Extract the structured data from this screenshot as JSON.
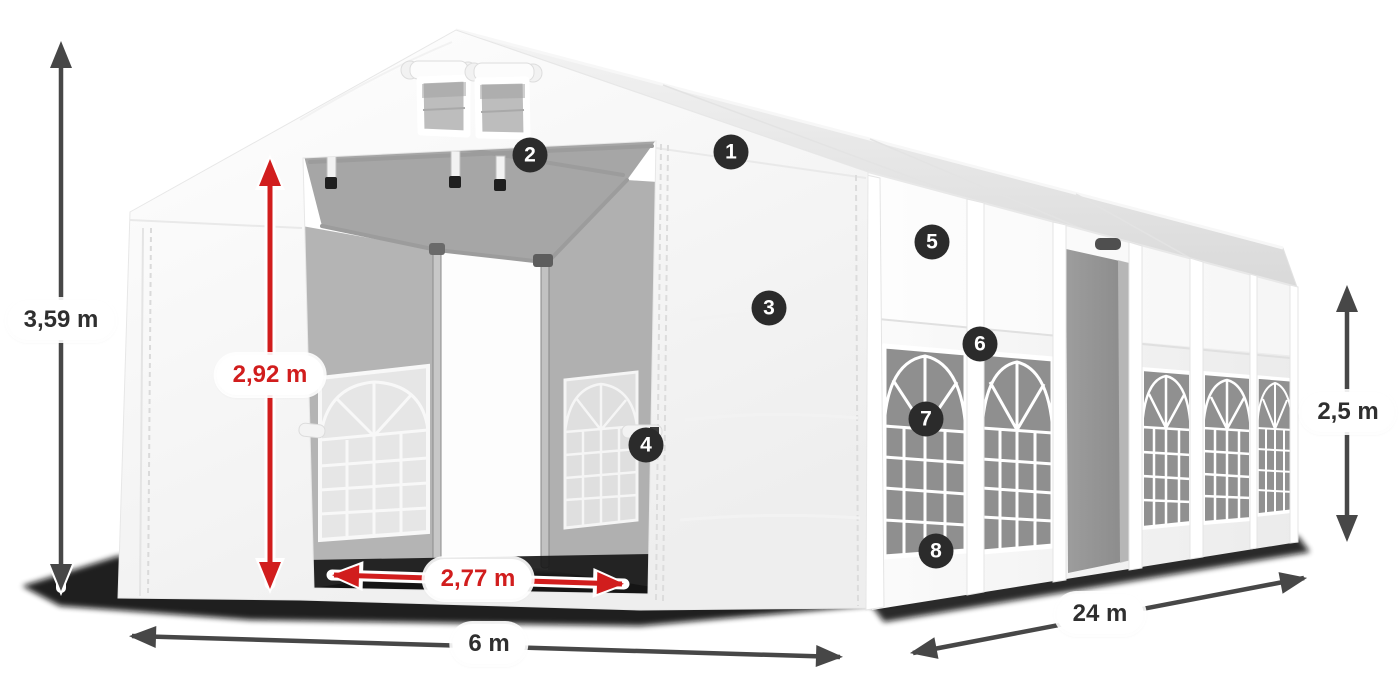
{
  "colors": {
    "dimension_red": "#d11d1d",
    "dimension_dark": "#474747",
    "badge_background": "#2b2b2b",
    "badge_text": "#ffffff",
    "label_background": "#ffffff",
    "label_text": "#2f2f2f"
  },
  "dimensions": {
    "total_height": {
      "label": "3,59 m",
      "style": "dark"
    },
    "entrance_height": {
      "label": "2,92 m",
      "style": "red"
    },
    "entrance_width": {
      "label": "2,77 m",
      "style": "red"
    },
    "front_width": {
      "label": "6 m",
      "style": "dark"
    },
    "side_length": {
      "label": "24 m",
      "style": "dark"
    },
    "side_height": {
      "label": "2,5 m",
      "style": "dark"
    }
  },
  "badges": [
    {
      "number": "1"
    },
    {
      "number": "2"
    },
    {
      "number": "3"
    },
    {
      "number": "4"
    },
    {
      "number": "5"
    },
    {
      "number": "6"
    },
    {
      "number": "7"
    },
    {
      "number": "8"
    }
  ]
}
